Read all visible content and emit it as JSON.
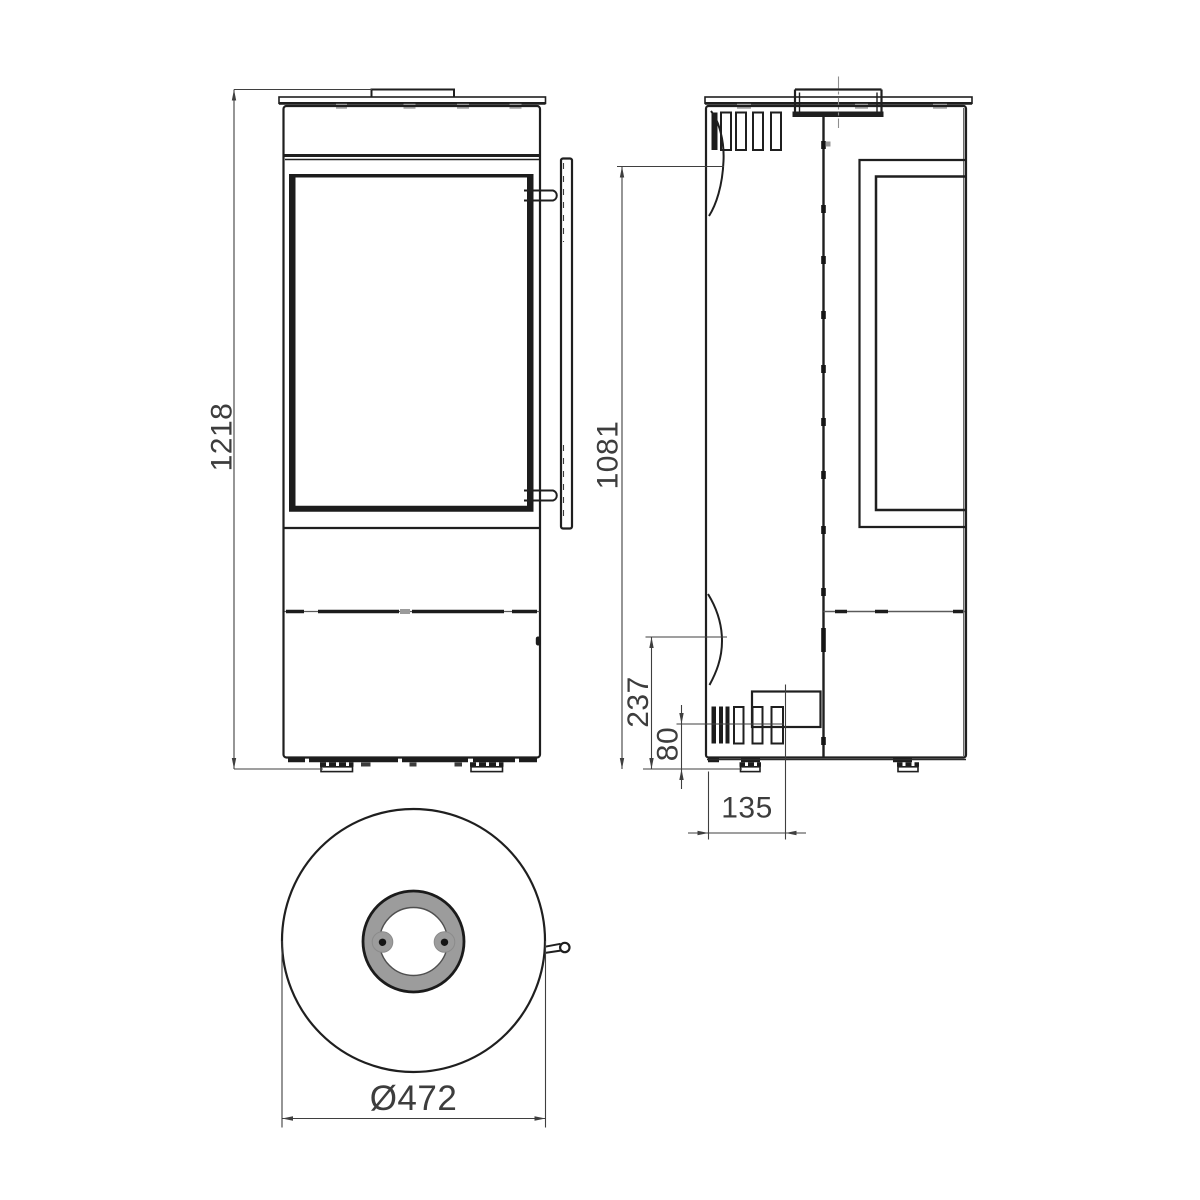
{
  "drawing": {
    "dimensions": {
      "front_height": "1218",
      "side_height": "1081",
      "side_lower_section": "237",
      "air_intake_height": "80",
      "air_intake_offset": "135",
      "top_diameter": "Ø472"
    },
    "colors": {
      "line": "#1f1f1f",
      "dimension_line": "#3f3f3f",
      "dimension_text": "#3d3d3d",
      "flue_ring_gray": "#9c9c9c",
      "clip_gray": "#a9a9a9",
      "background": "#ffffff"
    }
  }
}
